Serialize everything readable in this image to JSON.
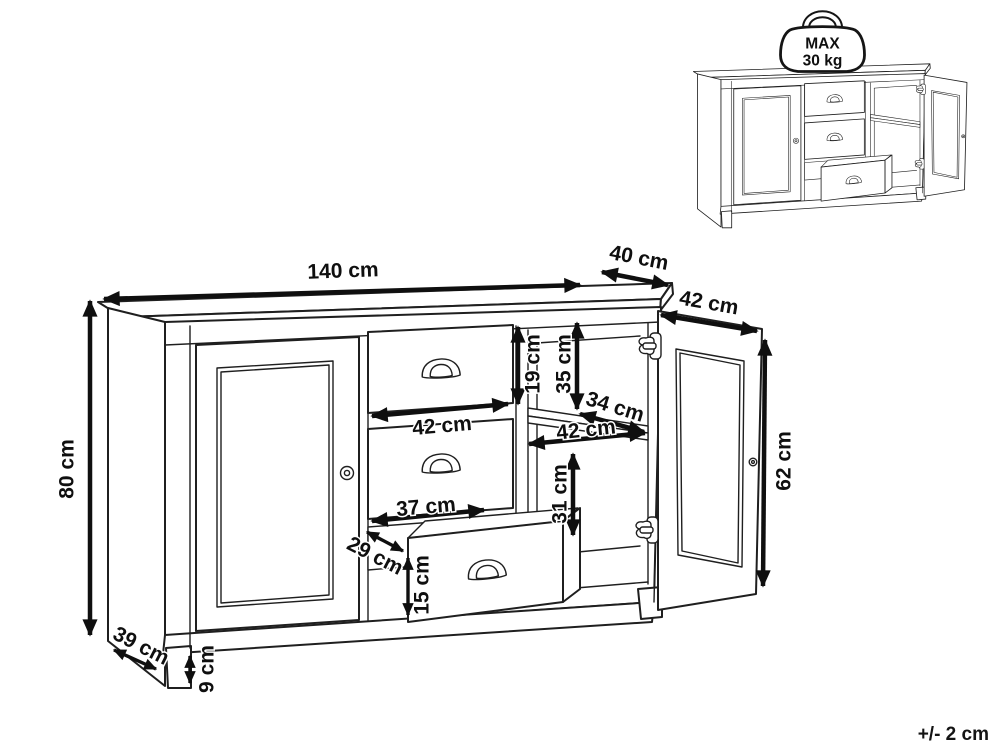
{
  "colors": {
    "background": "#ffffff",
    "drawing_line": "#1f1f1f",
    "annotation_ink": "#0f0f0f"
  },
  "diagram": {
    "tolerance": "+/- 2 cm",
    "max_load": {
      "line1": "MAX",
      "line2": "30 kg"
    },
    "dimensions": {
      "overall_width": "140 cm",
      "overall_depth": "40 cm",
      "overall_height": "80 cm",
      "side_base_depth": "39 cm",
      "plinth_height": "9 cm",
      "drawer_front_height": "19 cm",
      "upper_compartment_height": "35 cm",
      "drawer_front_width": "42 cm",
      "shelf_depth": "34 cm",
      "shelf_width": "42 cm",
      "lower_compartment_height": "31 cm",
      "drawer_inner_width": "37 cm",
      "drawer_inner_depth": "29 cm",
      "drawer_inner_height": "15 cm",
      "door_width": "42 cm",
      "door_height": "62 cm"
    }
  }
}
